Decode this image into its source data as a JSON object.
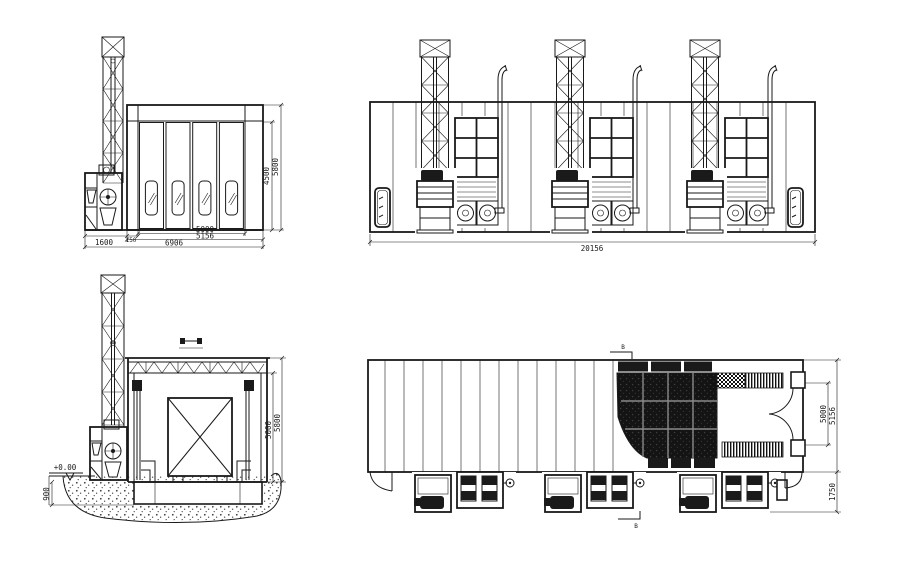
{
  "page": {
    "background": "#ffffff",
    "line_color": "#1a1a1a"
  },
  "front_view": {
    "dims": {
      "unit_width": "1600",
      "gap": "150",
      "inner_width": "5000",
      "booth_width": "5156",
      "total_width": "6906",
      "door_height": "4500",
      "total_height": "5800"
    }
  },
  "side_view": {
    "dims": {
      "total_length": "20156"
    }
  },
  "section_view": {
    "level_mark": "+0.00",
    "dims": {
      "pit_depth": "900",
      "inner_height": "5000",
      "total_height": "5800"
    }
  },
  "plan_view": {
    "section_letter_top": "B",
    "section_letter_bottom": "B",
    "dims": {
      "door_opening": "5000",
      "booth_width": "5156",
      "service_depth": "1750"
    }
  }
}
